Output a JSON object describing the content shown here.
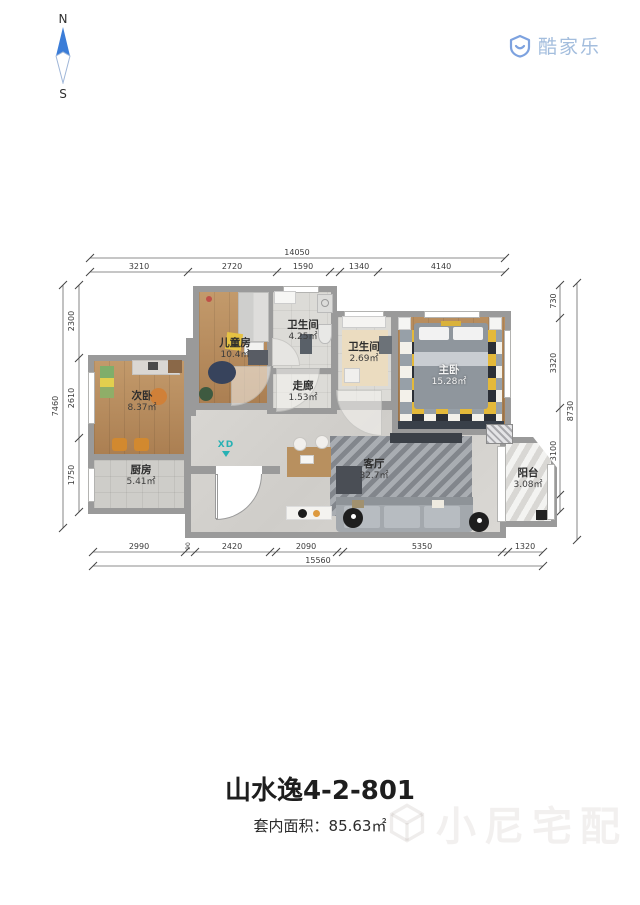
{
  "compass": {
    "north_label": "N",
    "south_label": "S"
  },
  "brand": {
    "logo_text": "酷家乐"
  },
  "rooms": [
    {
      "name": "儿童房",
      "area": "10.4㎡"
    },
    {
      "name": "卫生间",
      "area": "4.25㎡"
    },
    {
      "name": "卫生间",
      "area": "2.69㎡"
    },
    {
      "name": "主卧",
      "area": "15.28㎡"
    },
    {
      "name": "走廊",
      "area": "1.53㎡"
    },
    {
      "name": "次卧",
      "area": "8.37㎡"
    },
    {
      "name": "厨房",
      "area": "5.41㎡"
    },
    {
      "name": "客厅",
      "area": "32.7㎡"
    },
    {
      "name": "阳台",
      "area": "3.08㎡"
    }
  ],
  "entry": {
    "marker": "XD"
  },
  "dimensions": {
    "top": {
      "total": "14050",
      "segments": [
        "3210",
        "2720",
        "1590",
        "1340",
        "4140"
      ]
    },
    "bottom": {
      "total": "15560",
      "segments": [
        "2990",
        "90",
        "2420",
        "2090",
        "5350",
        "1320"
      ]
    },
    "left": {
      "total": "7460",
      "segments": [
        "2300",
        "2610",
        "1750"
      ]
    },
    "right": {
      "total": "8730",
      "segments": [
        "730",
        "3320",
        "3100",
        "500"
      ]
    }
  },
  "footer": {
    "title": "山水逸4-2-801",
    "area_label": "套内面积：",
    "area_value": "85.63㎡"
  },
  "watermark": {
    "text": "小尼宅配"
  },
  "colors": {
    "wall": "#9a9a9a",
    "compass_blue": "#3b7dd8",
    "logo_blue": "#a3bddd",
    "entry_teal": "#27b1b4"
  }
}
